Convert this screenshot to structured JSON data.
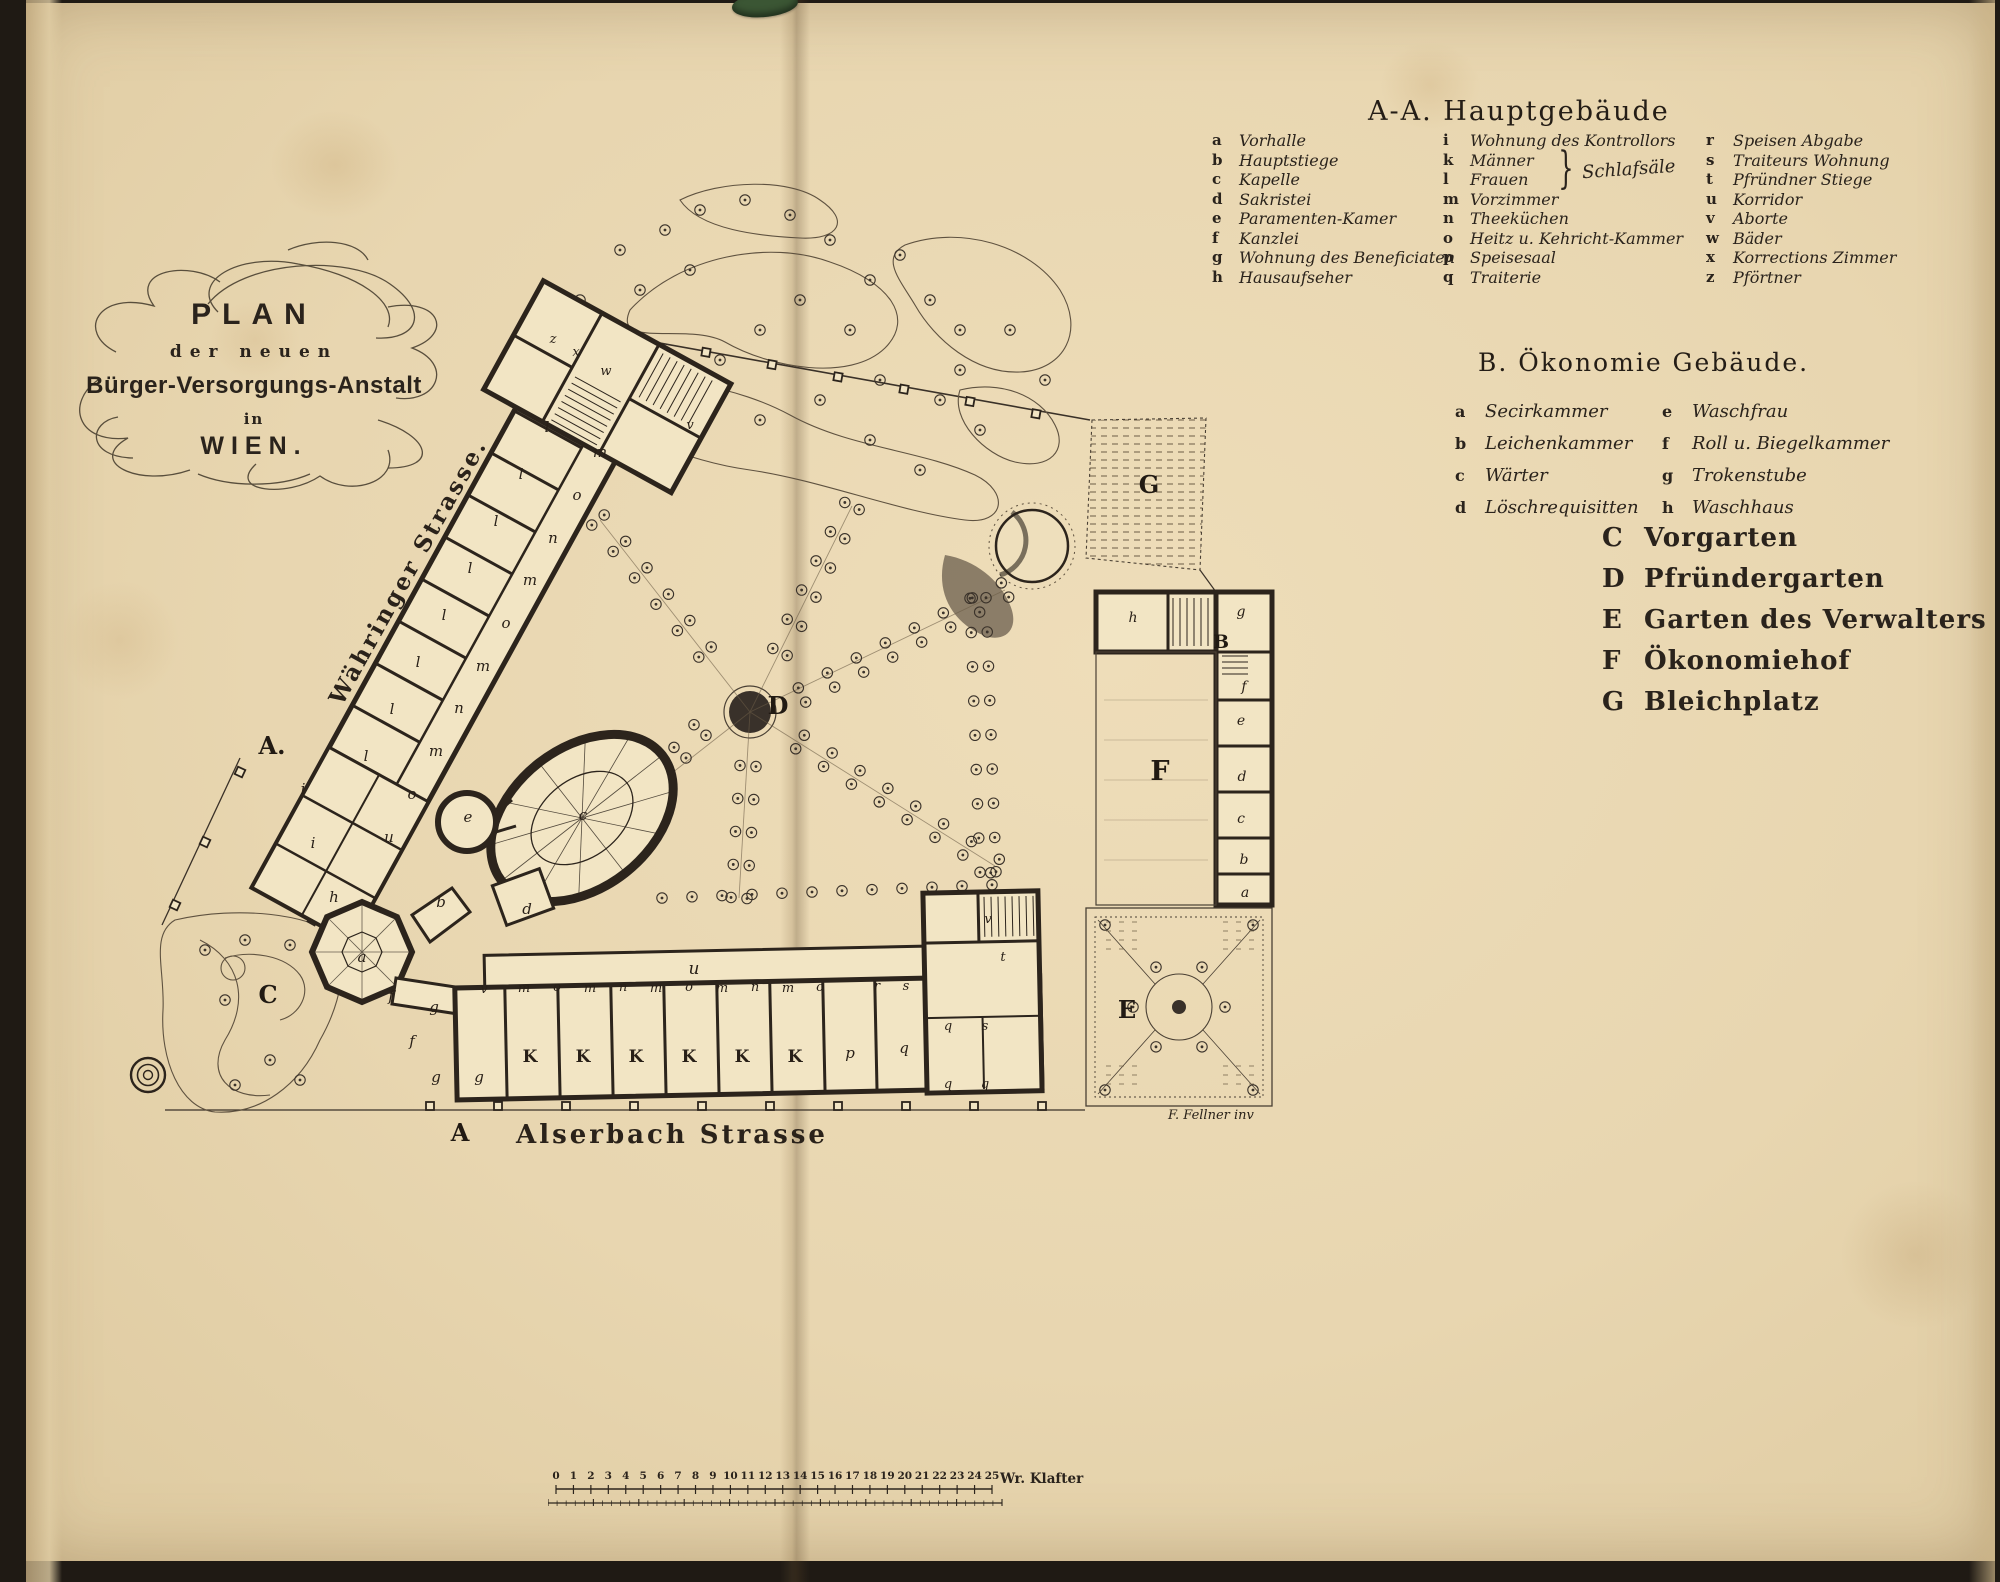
{
  "title": {
    "lines": [
      "PLAN",
      "der neuen",
      "Bürger-Versorgungs-Anstalt",
      "in",
      "WIEN."
    ]
  },
  "legend_a": {
    "heading": "A-A. Hauptgebäude",
    "col1": [
      {
        "k": "a",
        "v": "Vorhalle"
      },
      {
        "k": "b",
        "v": "Hauptstiege"
      },
      {
        "k": "c",
        "v": "Kapelle"
      },
      {
        "k": "d",
        "v": "Sakristei"
      },
      {
        "k": "e",
        "v": "Paramenten-Kamer"
      },
      {
        "k": "f",
        "v": "Kanzlei"
      },
      {
        "k": "g",
        "v": "Wohnung des Beneficiaten"
      },
      {
        "k": "h",
        "v": "Hausaufseher"
      }
    ],
    "col2": [
      {
        "k": "i",
        "v": "Wohnung des Kontrollors"
      },
      {
        "k": "k",
        "v": "Männer"
      },
      {
        "k": "l",
        "v": "Frauen"
      },
      {
        "k": "m",
        "v": "Vorzimmer"
      },
      {
        "k": "n",
        "v": "Theeküchen"
      },
      {
        "k": "o",
        "v": "Heitz u. Kehricht-Kammer"
      },
      {
        "k": "p",
        "v": "Speisesaal"
      },
      {
        "k": "q",
        "v": "Traiterie"
      }
    ],
    "brace_note": "Schlafsäle",
    "col3": [
      {
        "k": "r",
        "v": "Speisen Abgabe"
      },
      {
        "k": "s",
        "v": "Traiteurs Wohnung"
      },
      {
        "k": "t",
        "v": "Pfründner Stiege"
      },
      {
        "k": "u",
        "v": "Korridor"
      },
      {
        "k": "v",
        "v": "Aborte"
      },
      {
        "k": "w",
        "v": "Bäder"
      },
      {
        "k": "x",
        "v": "Korrections Zimmer"
      },
      {
        "k": "z",
        "v": "Pförtner"
      }
    ]
  },
  "legend_b": {
    "heading": "B. Ökonomie Gebäude.",
    "col1": [
      {
        "k": "a",
        "v": "Secirkammer"
      },
      {
        "k": "b",
        "v": "Leichenkammer"
      },
      {
        "k": "c",
        "v": "Wärter"
      },
      {
        "k": "d",
        "v": "Löschrequisitten"
      }
    ],
    "col2": [
      {
        "k": "e",
        "v": "Waschfrau"
      },
      {
        "k": "f",
        "v": "Roll u. Biegelkammer"
      },
      {
        "k": "g",
        "v": "Trokenstube"
      },
      {
        "k": "h",
        "v": "Waschhaus"
      }
    ]
  },
  "areas": [
    {
      "k": "C",
      "v": "Vorgarten"
    },
    {
      "k": "D",
      "v": "Pfründergarten"
    },
    {
      "k": "E",
      "v": "Garten des Verwalters"
    },
    {
      "k": "F",
      "v": "Ökonomiehof"
    },
    {
      "k": "G",
      "v": "Bleichplatz"
    }
  ],
  "scale_bar": {
    "numbers": [
      "0",
      "1",
      "2",
      "3",
      "4",
      "5",
      "6",
      "7",
      "8",
      "9",
      "10",
      "11",
      "12",
      "13",
      "14",
      "15",
      "16",
      "17",
      "18",
      "19",
      "20",
      "21",
      "22",
      "23",
      "24",
      "25"
    ],
    "unit": "Wr. Klafter"
  },
  "plan": {
    "street_labels": [
      {
        "t": "Währinger Strasse.",
        "x": 415,
        "y": 575,
        "r": -61,
        "s": 23
      },
      {
        "t": "Alserbach Strasse",
        "x": 672,
        "y": 1143,
        "r": 0,
        "s": 26
      }
    ],
    "signature": {
      "t": "F. Fellner inv",
      "x": 1168,
      "y": 1119
    },
    "area_labels": [
      {
        "t": "A.",
        "x": 272,
        "y": 754,
        "s": 24
      },
      {
        "t": "A",
        "x": 460,
        "y": 1141,
        "s": 24
      },
      {
        "t": "B",
        "x": 1221,
        "y": 648,
        "s": 19
      },
      {
        "t": "C",
        "x": 268,
        "y": 1003,
        "s": 24
      },
      {
        "t": "D",
        "x": 778,
        "y": 714,
        "s": 24
      },
      {
        "t": "E",
        "x": 1127,
        "y": 1018,
        "s": 24
      },
      {
        "t": "F",
        "x": 1160,
        "y": 780,
        "s": 27
      },
      {
        "t": "G",
        "x": 1149,
        "y": 493,
        "s": 24
      }
    ],
    "room_labels": [
      {
        "t": "l",
        "x": 547,
        "y": 432
      },
      {
        "t": "l",
        "x": 521,
        "y": 479
      },
      {
        "t": "l",
        "x": 496,
        "y": 526
      },
      {
        "t": "l",
        "x": 470,
        "y": 573
      },
      {
        "t": "l",
        "x": 444,
        "y": 620
      },
      {
        "t": "l",
        "x": 418,
        "y": 667
      },
      {
        "t": "l",
        "x": 392,
        "y": 714
      },
      {
        "t": "l",
        "x": 366,
        "y": 761
      },
      {
        "t": "m",
        "x": 600,
        "y": 457
      },
      {
        "t": "o",
        "x": 577,
        "y": 500
      },
      {
        "t": "n",
        "x": 553,
        "y": 543
      },
      {
        "t": "m",
        "x": 530,
        "y": 585
      },
      {
        "t": "o",
        "x": 506,
        "y": 628
      },
      {
        "t": "m",
        "x": 483,
        "y": 671
      },
      {
        "t": "n",
        "x": 459,
        "y": 713
      },
      {
        "t": "m",
        "x": 436,
        "y": 756
      },
      {
        "t": "o",
        "x": 412,
        "y": 799
      },
      {
        "t": "u",
        "x": 389,
        "y": 842
      },
      {
        "t": "z",
        "x": 553,
        "y": 343,
        "s": 13
      },
      {
        "t": "x",
        "x": 576,
        "y": 356,
        "s": 13
      },
      {
        "t": "w",
        "x": 606,
        "y": 375,
        "s": 13
      },
      {
        "t": "v",
        "x": 690,
        "y": 429,
        "s": 13
      },
      {
        "t": "a",
        "x": 362,
        "y": 962
      },
      {
        "t": "b",
        "x": 441,
        "y": 907
      },
      {
        "t": "d",
        "x": 527,
        "y": 914
      },
      {
        "t": "e",
        "x": 468,
        "y": 822
      },
      {
        "t": "c",
        "x": 583,
        "y": 820
      },
      {
        "t": "i",
        "x": 303,
        "y": 794
      },
      {
        "t": "i",
        "x": 313,
        "y": 848
      },
      {
        "t": "h",
        "x": 334,
        "y": 902
      },
      {
        "t": "f",
        "x": 391,
        "y": 1001
      },
      {
        "t": "f",
        "x": 412,
        "y": 1046
      },
      {
        "t": "g",
        "x": 434,
        "y": 1012
      },
      {
        "t": "g",
        "x": 436,
        "y": 1082
      },
      {
        "t": "g",
        "x": 479,
        "y": 1082
      },
      {
        "t": "v",
        "x": 484,
        "y": 993,
        "s": 13
      },
      {
        "t": "u",
        "x": 694,
        "y": 974,
        "s": 17
      },
      {
        "t": "m",
        "x": 524,
        "y": 992,
        "s": 13
      },
      {
        "t": "o",
        "x": 557,
        "y": 991,
        "s": 13
      },
      {
        "t": "m",
        "x": 590,
        "y": 992,
        "s": 13
      },
      {
        "t": "n",
        "x": 623,
        "y": 991,
        "s": 13
      },
      {
        "t": "m",
        "x": 656,
        "y": 992,
        "s": 13
      },
      {
        "t": "o",
        "x": 689,
        "y": 991,
        "s": 13
      },
      {
        "t": "m",
        "x": 722,
        "y": 992,
        "s": 13
      },
      {
        "t": "n",
        "x": 755,
        "y": 991,
        "s": 13
      },
      {
        "t": "m",
        "x": 788,
        "y": 992,
        "s": 13
      },
      {
        "t": "o",
        "x": 820,
        "y": 991,
        "s": 13
      },
      {
        "t": "r",
        "x": 877,
        "y": 990,
        "s": 13
      },
      {
        "t": "s",
        "x": 906,
        "y": 990,
        "s": 13
      },
      {
        "t": "K",
        "x": 530,
        "y": 1062,
        "s": 17,
        "u": 1
      },
      {
        "t": "K",
        "x": 583,
        "y": 1062,
        "s": 17,
        "u": 1
      },
      {
        "t": "K",
        "x": 636,
        "y": 1062,
        "s": 17,
        "u": 1
      },
      {
        "t": "K",
        "x": 689,
        "y": 1062,
        "s": 17,
        "u": 1
      },
      {
        "t": "K",
        "x": 742,
        "y": 1062,
        "s": 17,
        "u": 1
      },
      {
        "t": "K",
        "x": 795,
        "y": 1062,
        "s": 17,
        "u": 1
      },
      {
        "t": "p",
        "x": 850,
        "y": 1058
      },
      {
        "t": "q",
        "x": 904,
        "y": 1053
      },
      {
        "t": "q",
        "x": 948,
        "y": 1030,
        "s": 13
      },
      {
        "t": "s",
        "x": 985,
        "y": 1030,
        "s": 13
      },
      {
        "t": "q",
        "x": 948,
        "y": 1088,
        "s": 13
      },
      {
        "t": "q",
        "x": 985,
        "y": 1088,
        "s": 13
      },
      {
        "t": "t",
        "x": 1003,
        "y": 961,
        "s": 13
      },
      {
        "t": "v",
        "x": 988,
        "y": 923,
        "s": 13
      },
      {
        "t": "h",
        "x": 1133,
        "y": 622,
        "s": 14
      },
      {
        "t": "g",
        "x": 1241,
        "y": 616,
        "s": 14
      },
      {
        "t": "f",
        "x": 1244,
        "y": 691,
        "s": 14
      },
      {
        "t": "e",
        "x": 1241,
        "y": 725,
        "s": 14
      },
      {
        "t": "d",
        "x": 1242,
        "y": 781,
        "s": 14
      },
      {
        "t": "c",
        "x": 1241,
        "y": 823,
        "s": 14
      },
      {
        "t": "b",
        "x": 1244,
        "y": 864,
        "s": 14
      },
      {
        "t": "a",
        "x": 1245,
        "y": 897,
        "s": 14
      }
    ]
  },
  "colors": {
    "paper": "#e8d6b0",
    "ink": "#2c241c",
    "leaf_green": "#3b5634"
  }
}
